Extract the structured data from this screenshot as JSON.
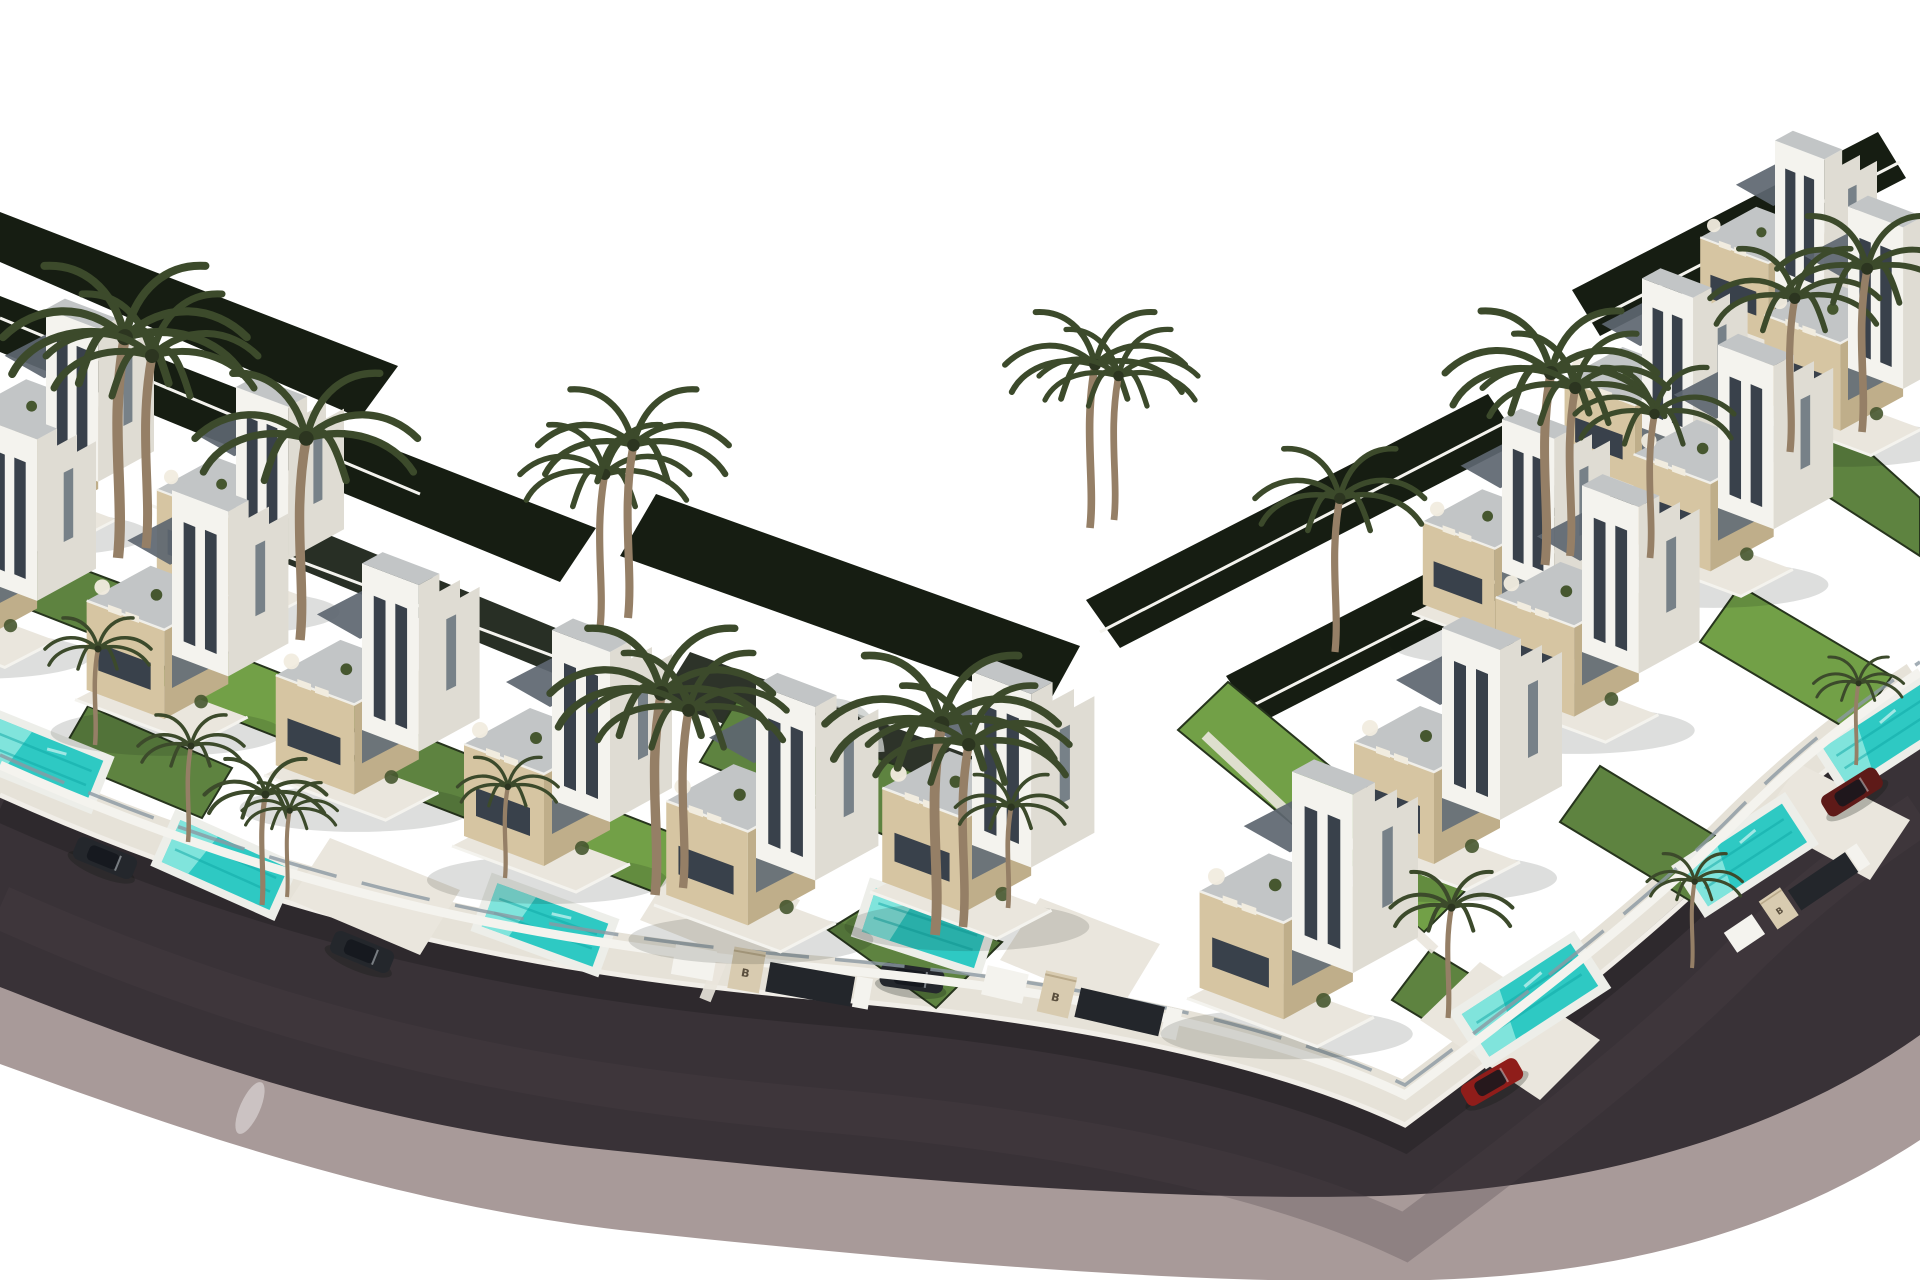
{
  "meta": {
    "domain": "natural-image",
    "title": "Aerial 3D render of a modern villa development",
    "description": "Computer-generated aerial rendering of a residential development: two diagonal rows of modern white villas with beige stone-clad towers, rooftop terraces, private turquoise pools, lawns and palm trees, arranged along a dark curved asphalt road with a mauve sidewalk, on a pure white background."
  },
  "scene": {
    "gate_monogram": "B",
    "counts": {
      "villas": 16,
      "pools": 7,
      "palm_trees": 26,
      "parked_cars": 5,
      "entrance_gates": 3
    },
    "elements": [
      "modern white villas with stepped parapets",
      "beige stone-clad tower volumes",
      "rooftop terraces with loungers and plants",
      "private turquoise swimming pools",
      "green lawns and dark hedges",
      "tall palm trees",
      "curved dark asphalt road with mauve sidewalk",
      "white perimeter walls and glass fences",
      "entrance gate pillars with monogram",
      "parked cars (dark grey, red, dark red)"
    ]
  },
  "colors": {
    "sky": "#ffffff",
    "asphalt": "#393237",
    "asphalt_dark": "#272226",
    "asphalt_sheen": "#4a4148",
    "sidewalk": "#a89a99",
    "curb": "#f1eee8",
    "paving": "#e6e2d8",
    "paving_light": "#eae6dd",
    "wall_white": "#f4f3ee",
    "tower_white": "#f4f3ee",
    "tower_side": "#dfdcd3",
    "deck": "#c2c5c6",
    "roof_slate": "#5d6670",
    "stone": "#d6c5a2",
    "stone_dark": "#bfae8a",
    "pillar_stone": "#d8cbb0",
    "glass": "#39414b",
    "glass_light": "#5d6a76",
    "glass_rail": "#8b98a2",
    "lawn": "#5e8340",
    "lawn_bright": "#72a047",
    "lawn_dark": "#27351d",
    "hedge_dark": "#161d12",
    "pool": "#2ec9c3",
    "pool_light": "#8ee9e0",
    "pool_dark": "#0fa8a6",
    "coping": "#edeee9",
    "palm": "#3c4a2b",
    "palm_core": "#2c3520",
    "trunk": "#957f66",
    "plant_green": "#46572f",
    "furniture": "#f1ecdf",
    "car_dark": "#24272c",
    "car_red": "#8f1d1a",
    "car_maroon": "#5e1a18",
    "gate_dark": "#23262b",
    "monogram": "#5a4f3e",
    "arch_grey": "#c9cdcb",
    "shadow": "#0d120c"
  }
}
